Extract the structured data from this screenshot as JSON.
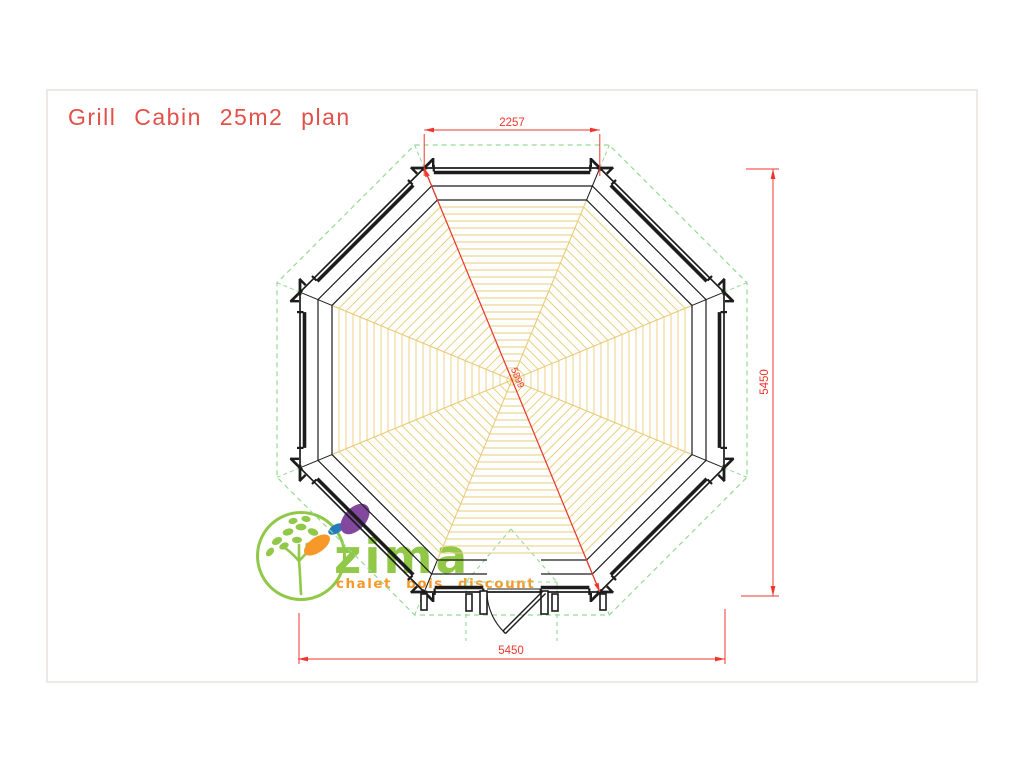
{
  "title": "Grill Cabin 25m2 plan",
  "drawing": {
    "name": "octagonal-grill-cabin-floor-plan",
    "dim_top": "2257",
    "dim_right": "5450",
    "dim_bottom": "5450",
    "dim_diagonal": "5899"
  },
  "logo": {
    "brand": "zima",
    "tagline": "chalet  bois  discount"
  },
  "colors": {
    "dimension_red": "#ee372c",
    "title_red": "#e25049",
    "overhang_green": "#93db93",
    "floor_board_yellow": "#e9cc78",
    "wall_black": "#1c1c1c",
    "sheet_border_gray": "#e8e2de",
    "logo_green": "#8cc63e",
    "logo_orange": "#f7941e",
    "logo_purple": "#7b3f98",
    "logo_blue": "#1b74bb"
  }
}
